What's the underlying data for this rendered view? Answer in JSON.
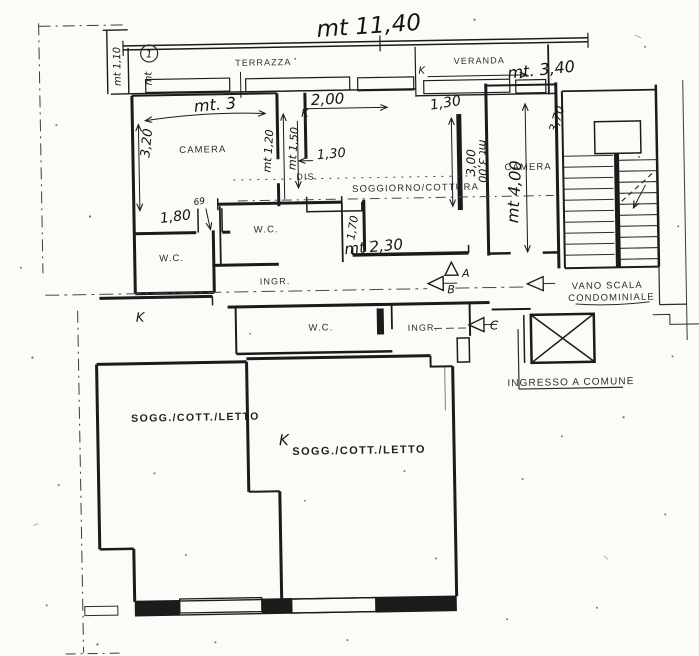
{
  "page": {
    "background": "#fbfbf8",
    "ink": "#1b1b1b"
  },
  "rooms": {
    "terrazza": "TERRAZZA",
    "veranda": "VERANDA",
    "camera_left": "CAMERA",
    "camera_right": "CAMERA",
    "disimpegno": "DIS.",
    "soggiorno_cottura": "SOGGIORNO/COTTURA",
    "wc_upper": "W.C.",
    "wc_left": "W.C.",
    "wc_lower": "W.C.",
    "ingresso_upper": "INGR.",
    "ingresso_lower": "INGR.",
    "sogg_cott_letto_left": "SOGG./COTT./LETTO",
    "sogg_cott_letto_center": "SOGG./COTT./LETTO",
    "vano_scala_line1": "VANO SCALA",
    "vano_scala_line2": "CONDOMINIALE",
    "ingresso_comune": "INGRESSO A COMUNE"
  },
  "dimensions": {
    "total_width": "mt 11,40",
    "veranda_width": "mt. 3,40",
    "camera_width": "mt. 3",
    "camera_depth": "3,20",
    "closet_depth": "mt 1,20",
    "closet_width": "mt 1,50",
    "kitchen_span": "2,00",
    "door_top_right": "1,30",
    "closet_door": "1,30",
    "camera_door": "1,80",
    "door_small": "69",
    "wall_seg": "1,70",
    "corridor_width": "mt 2,30",
    "soggiorno_depth_a": "3,00",
    "soggiorno_depth_b": "mt 3,00",
    "camera_right_depth": "mt 4,00",
    "stair_side": "3,70",
    "terrace_end": "mt 1,10",
    "terrace_note_prefix": "mt",
    "terrace_note_number": "1"
  },
  "markers": {
    "section_a": "A",
    "section_b": "B",
    "section_c": "C",
    "k1": "K",
    "k2": "K",
    "k3": "K",
    "k4": "K"
  }
}
